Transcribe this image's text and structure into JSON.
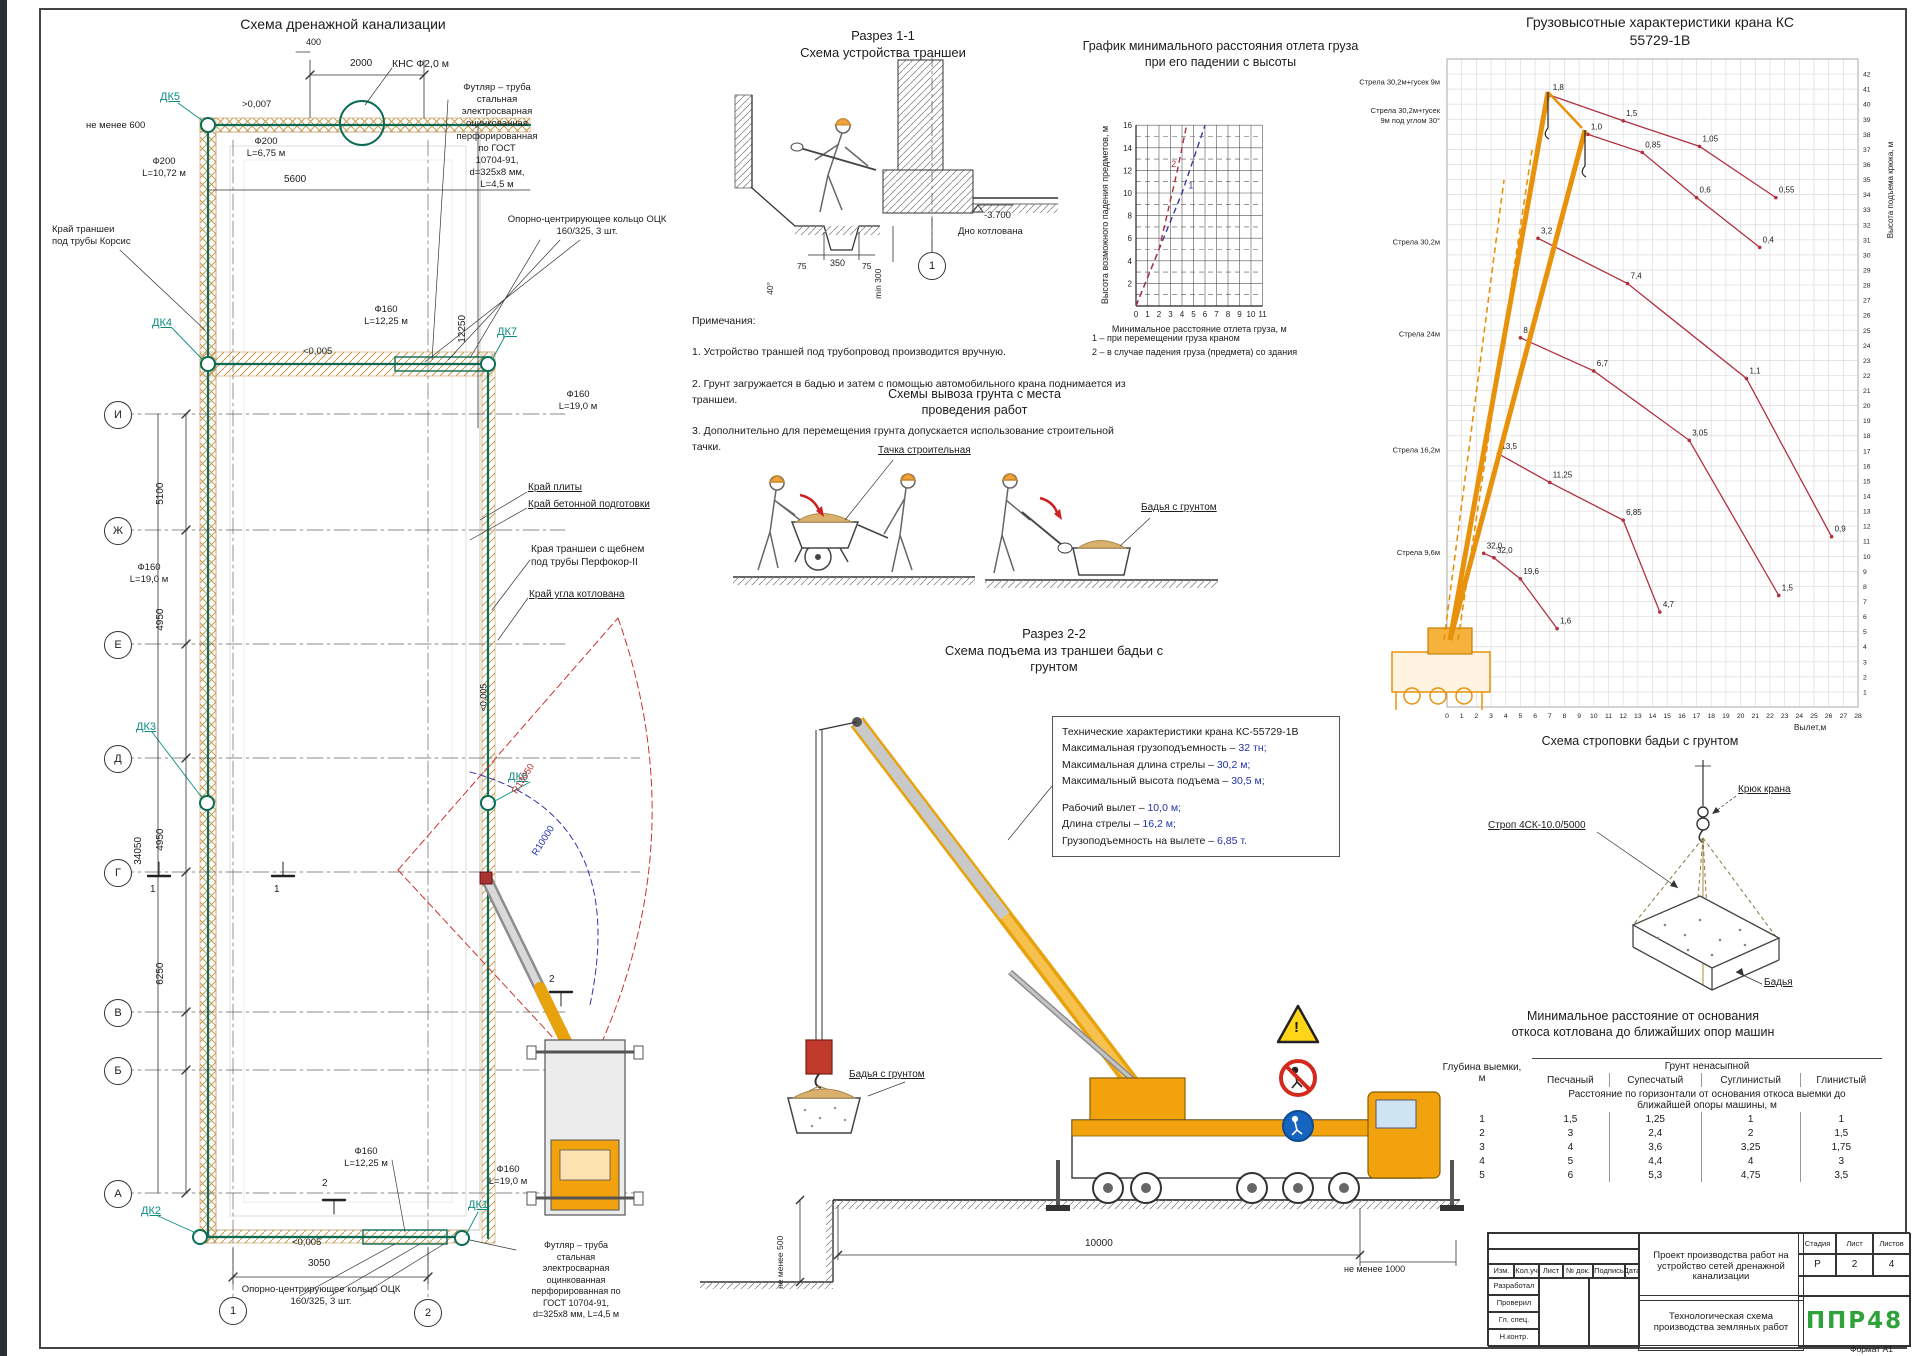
{
  "colors": {
    "pipe_green": "#0c6b54",
    "hatch_tan": "#c79b52",
    "dk_teal": "#0c8b80",
    "curve_red": "#b03040",
    "line_blue": "#3a3aa0",
    "crane_yellow": "#f2a20d",
    "crane_orange": "#e8920c",
    "logo_green": "#2fa23c"
  },
  "plan": {
    "title": "Схема дренажной канализации",
    "kns": "КНС Ф2,0 м",
    "casing_top": "Футляр – труба\nстальная\nэлектросварная\nоцинкованная\nперфорированная\nпо ГОСТ\n10704-91,\nd=325х8 мм,\nL=4,5 м",
    "casing_bottom": "Футляр – труба\nстальная\nэлектросварная\nоцинкованная\nперфорированная по\nГОСТ 10704-91,\nd=325х8 мм, L=4,5 м",
    "ock_top": "Опорно-центрирующее кольцо ОЦК\n160/325, 3 шт.",
    "ock_bottom": "Опорно-центрирующее кольцо ОЦК\n160/325, 3 шт.",
    "korsis": "Край траншеи\nпод трубы Корсис",
    "ne_menee_600": "не менее 600",
    "f200_1": "Ф200\nL=10,72 м",
    "f200_2": "Ф200\nL=6,75 м",
    "f160_1225": "Ф160\nL=12,25 м",
    "f160_19": "Ф160\nL=19,0 м",
    "edge_plate": "Край плиты",
    "edge_concrete": "Край бетонной подготовки",
    "edge_trench": "Края траншеи с щебнем\nпод трубы Перфокор-II",
    "edge_pit": "Край угла котлована",
    "slope_top": ">0,007",
    "slope_005": "<0,005",
    "d400": "400",
    "d2000": "2000",
    "d5600": "5600",
    "d12250": "12250",
    "d3050": "3050",
    "d5100": "5100",
    "d4950": "4950",
    "d34050": "34050",
    "d6250": "6250",
    "radius_red": "R13050",
    "radius_blue": "R10000",
    "flag1": "1",
    "flag2": "2",
    "axes": [
      "И",
      "Ж",
      "Е",
      "Д",
      "Г",
      "В",
      "Б",
      "А"
    ],
    "col_bubbles": [
      "1",
      "2"
    ],
    "dk": {
      "dk5": "ДК5",
      "dk4": "ДК4",
      "dk7": "ДК7",
      "dk3": "ДК3",
      "dk6": "ДК6",
      "dk2": "ДК2",
      "dk1": "ДК1"
    }
  },
  "s11": {
    "title": "Разрез 1-1\nСхема устройства траншеи",
    "d350": "350",
    "d75": "75",
    "min300": "min 300",
    "angle": "40°",
    "elev": "-3.700",
    "bottom": "Дно котлована",
    "bubble": "1"
  },
  "notes": {
    "heading": "Примечания:",
    "items": [
      "1. Устройство траншей под трубопровод производится вручную.",
      "2. Грунт загружается в бадью и затем с помощью автомобильного крана поднимается из траншеи.",
      "3. Дополнительно для перемещения грунта допускается использование строительной тачки."
    ]
  },
  "soil": {
    "title": "Схемы вывоза грунта с места\nпроведения работ",
    "cart_label": "Тачка строительная",
    "bucket_label": "Бадья с грунтом"
  },
  "s22": {
    "title": "Разрез 2-2\nСхема подъема из траншеи бадьи с\nгрунтом",
    "specs_title": "Технические характеристики крана КС-55729-1В",
    "specs": [
      {
        "label": "Максимальная грузоподъемность – ",
        "value": "32 тн;"
      },
      {
        "label": "Максимальная длина стрелы – ",
        "value": "30,2 м;"
      },
      {
        "label": "Максимальный высота подъема – ",
        "value": "30,5 м;"
      },
      {
        "label": "Рабочий вылет – ",
        "value": "10,0 м;"
      },
      {
        "label": "Длина стрелы – ",
        "value": "16,2 м;"
      },
      {
        "label": "Грузоподъемность на вылете – ",
        "value": "6,85 т."
      }
    ],
    "bucket_label": "Бадья с грунтом",
    "dim_10000": "10000",
    "dim_1000": "не менее 1000",
    "dim_500": "не менее 500",
    "sign_warning": "!"
  },
  "sling": {
    "title": "Схема строповки бадьи с грунтом",
    "hook": "Крюк крана",
    "strop": "Строп 4СК-10.0/5000",
    "bucket": "Бадья"
  },
  "dist_table": {
    "title": "Минимальное расстояние от основания\nоткоса котлована до ближайших опор машин",
    "depth_header": "Глубина выемки,\nм",
    "group_header": "Грунт ненасыпной",
    "soils": [
      "Песчаный",
      "Супесчатый",
      "Суглинистый",
      "Глинистый"
    ],
    "note": "Расстояние по горизонтали от основания откоса выемки до\nближайшей опоры машины, м",
    "rows": [
      [
        "1",
        "1,5",
        "1,25",
        "1",
        "1"
      ],
      [
        "2",
        "3",
        "2,4",
        "2",
        "1,5"
      ],
      [
        "3",
        "4",
        "3,6",
        "3,25",
        "1,75"
      ],
      [
        "4",
        "5",
        "4,4",
        "4",
        "3"
      ],
      [
        "5",
        "6",
        "5,3",
        "4,75",
        "3,5"
      ]
    ]
  },
  "title_block": {
    "cols": [
      "Изм.",
      "Кол.уч",
      "Лист",
      "№ док.",
      "Подпись",
      "Дата"
    ],
    "rows": [
      "Разработал",
      "Проверил",
      "Гл. спец.",
      "Н.контр."
    ],
    "project": "Проект производства работ на устройство сетей дренажной канализации",
    "subtitle": "Технологическая схема производства земляных работ",
    "stage_h": "Стадия",
    "sheet_h": "Лист",
    "sheets_h": "Листов",
    "stage": "Р",
    "sheet": "2",
    "sheets": "4",
    "logo": "ППР48",
    "format": "Формат А1"
  },
  "chart_data": [
    {
      "id": "fall",
      "type": "line",
      "title": "График минимального расстояния отлета груза при его падении с высоты",
      "xlabel": "Минимальное расстояние отлета груза, м",
      "ylabel": "Высота возможного падения предметов, м",
      "xlim": [
        0,
        11
      ],
      "ylim": [
        0,
        16
      ],
      "grid": true,
      "legend_position": "below",
      "series": [
        {
          "name": "1 – при перемещении груза краном",
          "color": "#3a3aa0",
          "dash": "6 4",
          "points": [
            [
              0,
              0
            ],
            [
              2,
              5
            ],
            [
              4,
              10
            ],
            [
              6,
              16
            ]
          ],
          "inline_label": "1",
          "inline_at": [
            4.55,
            10.4
          ]
        },
        {
          "name": "2 – в случае падения груза (предмета) со здания",
          "color": "#b03040",
          "dash": "6 4",
          "points": [
            [
              0,
              0
            ],
            [
              2,
              5
            ],
            [
              3.6,
              12
            ],
            [
              4.4,
              16
            ]
          ],
          "inline_label": "2",
          "inline_at": [
            3.05,
            12.3
          ]
        }
      ]
    },
    {
      "id": "crane",
      "type": "line",
      "title": "Грузовысотные характеристики крана КС 55729-1В",
      "xlabel": "Вылет,м",
      "ylabel": "Высота подъема крюка, м",
      "xlim": [
        0,
        28
      ],
      "ylim": [
        0,
        43
      ],
      "grid": true,
      "series": [
        {
          "label_lines": [
            "Стрела 30,2м+гусек 9м"
          ],
          "label_y": 41.3,
          "color": "#b03040",
          "points": [
            [
              7,
              40.6
            ],
            [
              12,
              38.9
            ],
            [
              17.2,
              37.2
            ],
            [
              22.4,
              33.8
            ]
          ],
          "point_labels": [
            "1,8",
            "1,5",
            "1,05",
            "0,55"
          ]
        },
        {
          "label_lines": [
            "Стрела 30,2м+гусек",
            "9м под углом 30°"
          ],
          "label_y": 39.4,
          "color": "#b03040",
          "points": [
            [
              9.6,
              38
            ],
            [
              13.3,
              36.8
            ],
            [
              17,
              33.8
            ],
            [
              21.3,
              30.5
            ]
          ],
          "point_labels": [
            "1,0",
            "0,85",
            "0,6",
            "0,4"
          ]
        },
        {
          "label_lines": [
            "Стрела 30,2м"
          ],
          "label_y": 30.7,
          "color": "#b03040",
          "points": [
            [
              6.2,
              31.1
            ],
            [
              12.3,
              28.1
            ],
            [
              20.4,
              21.8
            ],
            [
              26.2,
              11.3
            ]
          ],
          "point_labels": [
            "3,2",
            "7,4",
            "1,1",
            "0,9"
          ]
        },
        {
          "label_lines": [
            "Стрела 24м"
          ],
          "label_y": 24.6,
          "color": "#b03040",
          "points": [
            [
              5,
              24.5
            ],
            [
              10,
              22.3
            ],
            [
              16.5,
              17.7
            ],
            [
              22.6,
              7.4
            ]
          ],
          "point_labels": [
            "8,7",
            "6,7",
            "3,05",
            "1,5"
          ]
        },
        {
          "label_lines": [
            "Стрела 16,2м"
          ],
          "label_y": 16.9,
          "color": "#b03040",
          "points": [
            [
              3.5,
              16.8
            ],
            [
              7,
              14.9
            ],
            [
              12,
              12.4
            ],
            [
              14.5,
              6.3
            ]
          ],
          "point_labels": [
            "13,5",
            "11,25",
            "6,85",
            "4,7"
          ]
        },
        {
          "label_lines": [
            "Стрела 9,6м"
          ],
          "label_y": 10.1,
          "color": "#b03040",
          "points": [
            [
              2.5,
              10.2
            ],
            [
              3.2,
              9.9
            ],
            [
              5,
              8.5
            ],
            [
              7.5,
              5.2
            ]
          ],
          "point_labels": [
            "32,0",
            "32,0",
            "19,6",
            "1,6"
          ]
        }
      ]
    }
  ]
}
